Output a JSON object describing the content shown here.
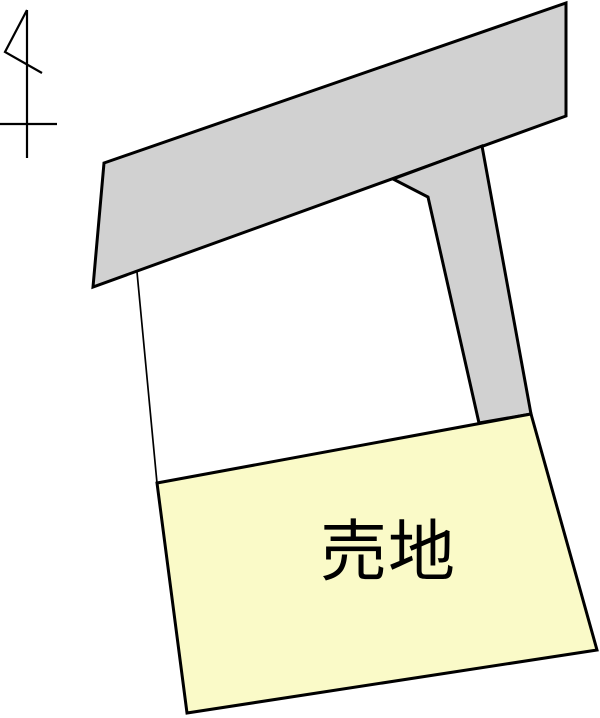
{
  "map": {
    "background_color": "#ffffff",
    "line_color": "#000000"
  },
  "icons": {
    "north_arrow": "north-arrow-icon"
  },
  "roads": {
    "fill": "#d1d1d1"
  },
  "parcels": {
    "adjacent": {
      "fill": "#ffffff"
    },
    "sale": {
      "label": "売地",
      "fill": "#fafac8",
      "label_color": "#000000"
    }
  }
}
